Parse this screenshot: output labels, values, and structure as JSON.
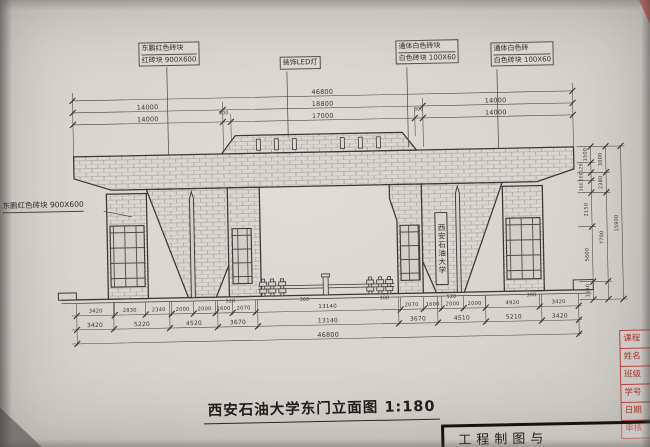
{
  "title": "西安石油大学东门立面图 1:180",
  "gate_sign": "西安石油大学",
  "side_label": "东鹏红色砖块 900X600",
  "callouts": [
    {
      "lines": [
        "东鹏红色砖块",
        "红砖块 900X600"
      ]
    },
    {
      "lines": [
        "装饰LED灯"
      ]
    },
    {
      "lines": [
        "通体白色砖块",
        "白色砖块 100X60"
      ]
    },
    {
      "lines": [
        "通体白色砖",
        "白色砖块 100X60"
      ]
    }
  ],
  "stamp_table": {
    "color": "#b5443c",
    "rows": [
      "课程",
      "姓名",
      "班级",
      "学号",
      "日期",
      "审核"
    ]
  },
  "bottom_block": {
    "course": "工程制图与",
    "scale_label": "比例"
  },
  "dimensions": {
    "top": {
      "total": "46800",
      "row2": [
        "14000",
        "18800",
        "14000"
      ],
      "row3": [
        "14000",
        "800",
        "17000",
        "800",
        "14000"
      ]
    },
    "bottom": {
      "row1": [
        "3420",
        "2830",
        "2340",
        "2000",
        "2000",
        "1600",
        "2070",
        "13140",
        "2070",
        "1600",
        "2000",
        "2000",
        "4920",
        "3420"
      ],
      "row1_small": [
        "520",
        "300",
        "300",
        "520",
        "300"
      ],
      "row2": [
        "3420",
        "5220",
        "4520",
        "3670",
        "13140",
        "3670",
        "4510",
        "5210",
        "3420"
      ],
      "total": "46800"
    },
    "right_vertical": {
      "inner": [
        "1500",
        "120",
        "200",
        "300",
        "2150",
        "5600",
        "1580"
      ],
      "middle": [
        "3000",
        "2380",
        "7700"
      ],
      "total": "15900"
    }
  },
  "dim_labels": [
    {
      "t": "46800",
      "x": 325,
      "y": 92,
      "s": 6.5
    },
    {
      "t": "14000",
      "x": 150,
      "y": 104,
      "s": 6.5
    },
    {
      "t": "18800",
      "x": 325,
      "y": 104,
      "s": 6.5
    },
    {
      "t": "14000",
      "x": 498,
      "y": 104,
      "s": 6.5
    },
    {
      "t": "14000",
      "x": 150,
      "y": 116,
      "s": 6.5
    },
    {
      "t": "800",
      "x": 226,
      "y": 112,
      "s": 4.8
    },
    {
      "t": "17000",
      "x": 325,
      "y": 116,
      "s": 6.5
    },
    {
      "t": "800",
      "x": 421,
      "y": 112,
      "s": 4.8
    },
    {
      "t": "14000",
      "x": 498,
      "y": 116,
      "s": 6.5
    },
    {
      "t": "520",
      "x": 229,
      "y": 300,
      "s": 4.8
    },
    {
      "t": "300",
      "x": 303,
      "y": 300,
      "s": 4.8
    },
    {
      "t": "300",
      "x": 383,
      "y": 300,
      "s": 4.8
    },
    {
      "t": "520",
      "x": 450,
      "y": 300,
      "s": 4.8
    },
    {
      "t": "300",
      "x": 530,
      "y": 300,
      "s": 4.8
    },
    {
      "t": "3420",
      "x": 94,
      "y": 307,
      "s": 5.2
    },
    {
      "t": "2830",
      "x": 128,
      "y": 307,
      "s": 5.2
    },
    {
      "t": "2340",
      "x": 157,
      "y": 307,
      "s": 5.2
    },
    {
      "t": "2000",
      "x": 181,
      "y": 307,
      "s": 5.2
    },
    {
      "t": "2000",
      "x": 203,
      "y": 307,
      "s": 5.2
    },
    {
      "t": "1600",
      "x": 222,
      "y": 307,
      "s": 5.2
    },
    {
      "t": "2070",
      "x": 242,
      "y": 307,
      "s": 5.2
    },
    {
      "t": "13140",
      "x": 326,
      "y": 307,
      "s": 5.5
    },
    {
      "t": "2070",
      "x": 410,
      "y": 307,
      "s": 5.2
    },
    {
      "t": "1600",
      "x": 431,
      "y": 307,
      "s": 5.2
    },
    {
      "t": "2000",
      "x": 451,
      "y": 307,
      "s": 5.2
    },
    {
      "t": "2000",
      "x": 473,
      "y": 307,
      "s": 5.2
    },
    {
      "t": "4920",
      "x": 511,
      "y": 307,
      "s": 5.2
    },
    {
      "t": "3420",
      "x": 557,
      "y": 307,
      "s": 5.2
    },
    {
      "t": "3420",
      "x": 93,
      "y": 321,
      "s": 6
    },
    {
      "t": "5220",
      "x": 140,
      "y": 321,
      "s": 6
    },
    {
      "t": "4520",
      "x": 192,
      "y": 321,
      "s": 6
    },
    {
      "t": "3670",
      "x": 236,
      "y": 321,
      "s": 6
    },
    {
      "t": "13140",
      "x": 326,
      "y": 321,
      "s": 6
    },
    {
      "t": "3670",
      "x": 416,
      "y": 321,
      "s": 6
    },
    {
      "t": "4510",
      "x": 460,
      "y": 321,
      "s": 6
    },
    {
      "t": "5210",
      "x": 512,
      "y": 321,
      "s": 6
    },
    {
      "t": "3420",
      "x": 558,
      "y": 321,
      "s": 6
    },
    {
      "t": "46800",
      "x": 326,
      "y": 335,
      "s": 6.5
    },
    {
      "t": "1500",
      "x": 587,
      "y": 160,
      "s": 5,
      "r": -90
    },
    {
      "t": "120",
      "x": 583,
      "y": 173,
      "s": 4.5,
      "r": -90
    },
    {
      "t": "200",
      "x": 583,
      "y": 182,
      "s": 4.5,
      "r": -90
    },
    {
      "t": "300",
      "x": 583,
      "y": 192,
      "s": 4.5,
      "r": -90
    },
    {
      "t": "2150",
      "x": 587,
      "y": 215,
      "s": 5,
      "r": -90
    },
    {
      "t": "5600",
      "x": 587,
      "y": 260,
      "s": 5,
      "r": -90
    },
    {
      "t": "1580",
      "x": 587,
      "y": 296,
      "s": 5,
      "r": -90
    },
    {
      "t": "3000",
      "x": 602,
      "y": 165,
      "s": 5,
      "r": -90
    },
    {
      "t": "2380",
      "x": 602,
      "y": 188,
      "s": 5,
      "r": -90
    },
    {
      "t": "7700",
      "x": 602,
      "y": 243,
      "s": 5,
      "r": -90
    },
    {
      "t": "15900",
      "x": 617,
      "y": 229,
      "s": 5,
      "r": -90
    }
  ],
  "dim_ticks": {
    "rows": [
      {
        "y": 96,
        "xs": [
          75,
          575
        ]
      },
      {
        "y": 108,
        "xs": [
          75,
          225,
          425,
          575
        ]
      },
      {
        "y": 120,
        "xs": [
          75,
          225,
          233,
          417,
          425,
          575
        ]
      },
      {
        "y": 311,
        "xs": [
          75,
          113,
          144,
          170,
          192,
          214,
          231,
          254,
          399,
          422,
          440,
          462,
          484,
          538,
          577
        ]
      },
      {
        "y": 325,
        "xs": [
          75,
          112,
          168,
          216,
          256,
          397,
          436,
          484,
          540,
          577
        ]
      },
      {
        "y": 339,
        "xs": [
          75,
          577
        ]
      }
    ],
    "cols": [
      {
        "x": 592,
        "ys": [
          152,
          168,
          178,
          186,
          198,
          232,
          287,
          305
        ]
      },
      {
        "x": 607,
        "ys": [
          152,
          178,
          198,
          287,
          305
        ]
      },
      {
        "x": 622,
        "ys": [
          152,
          305
        ]
      }
    ]
  }
}
